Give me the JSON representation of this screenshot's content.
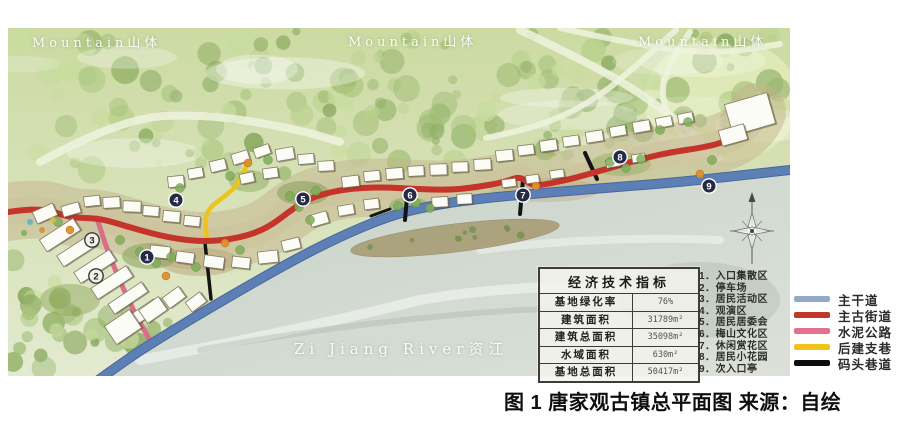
{
  "caption": "图 1 唐家观古镇总平面图  来源：自绘",
  "map_labels": {
    "mountain_left": "Mountain山体",
    "mountain_center": "Mountain山体",
    "mountain_right": "Mountain山体",
    "river": "Zi Jiang River资江"
  },
  "indicators_table": {
    "title": "经济技术指标",
    "rows": [
      {
        "label": "基地绿化率",
        "value": "76%"
      },
      {
        "label": "建筑面积",
        "value": "31789m²"
      },
      {
        "label": "建筑总面积",
        "value": "35098m²"
      },
      {
        "label": "水域面积",
        "value": "630m²"
      },
      {
        "label": "基地总面积",
        "value": "50417m²"
      }
    ]
  },
  "zones": [
    {
      "num": "1．",
      "name": "入口集散区"
    },
    {
      "num": "2．",
      "name": "停车场"
    },
    {
      "num": "3．",
      "name": "居民活动区"
    },
    {
      "num": "4．",
      "name": "观演区"
    },
    {
      "num": "5．",
      "name": "居民居委会"
    },
    {
      "num": "6．",
      "name": "梅山文化区"
    },
    {
      "num": "7．",
      "name": "休闲赏花区"
    },
    {
      "num": "8．",
      "name": "居民小花园"
    },
    {
      "num": "9．",
      "name": "次入口亭"
    }
  ],
  "legend": [
    {
      "label": "主干道",
      "color": "#93a9c9"
    },
    {
      "label": "主古街道",
      "color": "#c0372c"
    },
    {
      "label": "水泥公路",
      "color": "#e4718e"
    },
    {
      "label": "后建支巷",
      "color": "#f2c318"
    },
    {
      "label": "码头巷道",
      "color": "#0d0d0d"
    }
  ],
  "markers": [
    {
      "n": "1",
      "x": 147,
      "y": 257,
      "light": false
    },
    {
      "n": "2",
      "x": 96,
      "y": 276,
      "light": true
    },
    {
      "n": "3",
      "x": 92,
      "y": 240,
      "light": true
    },
    {
      "n": "4",
      "x": 176,
      "y": 200,
      "light": false
    },
    {
      "n": "5",
      "x": 303,
      "y": 199,
      "light": false
    },
    {
      "n": "6",
      "x": 410,
      "y": 195,
      "light": false
    },
    {
      "n": "7",
      "x": 523,
      "y": 195,
      "light": false
    },
    {
      "n": "8",
      "x": 620,
      "y": 157,
      "light": false
    },
    {
      "n": "9",
      "x": 709,
      "y": 186,
      "light": false
    }
  ],
  "map_art": {
    "palette": {
      "base_top": "#ccdaa2",
      "base_bottom": "#e3ead0",
      "river_a": "#c7d2c9",
      "river_b": "#dce1d8",
      "ground": "#c3b48c",
      "ground2": "#cdbf98",
      "grass": "#dfeab8",
      "mountain_path": "#eef3de",
      "building_fill": "#fcfcf6",
      "building_stroke": "#877a63",
      "tree_palette": [
        "#a8c47c",
        "#94b368",
        "#b9d28e",
        "#87a85c",
        "#c8dc9e",
        "#9cb873"
      ],
      "orange_tree": "#e08f2e",
      "town_tree": "#7fae5a",
      "marker_dark": "#252b47",
      "marker_light": "#f2f1ea",
      "sandbar": "#a3956a"
    },
    "roads_bg": [
      {
        "width": 8,
        "points": [
          [
            40,
            162
          ],
          [
            120,
            118
          ],
          [
            210,
            114
          ],
          [
            300,
            130
          ],
          [
            340,
            142
          ]
        ]
      },
      {
        "width": 8,
        "points": [
          [
            520,
            30
          ],
          [
            600,
            68
          ],
          [
            662,
            108
          ],
          [
            700,
            140
          ]
        ]
      },
      {
        "width": 6,
        "points": [
          [
            560,
            28
          ],
          [
            640,
            46
          ],
          [
            718,
            54
          ],
          [
            780,
            44
          ]
        ]
      },
      {
        "width": 6,
        "points": [
          [
            690,
            32
          ],
          [
            664,
            70
          ],
          [
            662,
            108
          ],
          [
            688,
            144
          ],
          [
            720,
            158
          ]
        ]
      },
      {
        "width": 6,
        "points": [
          [
            676,
            30
          ],
          [
            630,
            72
          ],
          [
            588,
            104
          ],
          [
            540,
            126
          ],
          [
            486,
            138
          ]
        ]
      }
    ],
    "river": [
      [
        101,
        376
      ],
      [
        138,
        354
      ],
      [
        178,
        331
      ],
      [
        222,
        304
      ],
      [
        266,
        278
      ],
      [
        310,
        252
      ],
      [
        354,
        230
      ],
      [
        398,
        213
      ],
      [
        443,
        203
      ],
      [
        488,
        197
      ],
      [
        534,
        193
      ],
      [
        584,
        189
      ],
      [
        634,
        185
      ],
      [
        685,
        181
      ],
      [
        738,
        175
      ],
      [
        790,
        169
      ],
      [
        790,
        376
      ]
    ],
    "roads": [
      {
        "name": "cement-road",
        "color": "#d96e88",
        "width": 5,
        "points": [
          [
            97,
            218
          ],
          [
            106,
            247
          ],
          [
            117,
            274
          ],
          [
            128,
            299
          ],
          [
            138,
            319
          ],
          [
            152,
            344
          ]
        ]
      },
      {
        "name": "branch-alley",
        "color": "#edc41e",
        "width": 4.5,
        "points": [
          [
            247,
            164
          ],
          [
            239,
            184
          ],
          [
            224,
            197
          ],
          [
            210,
            207
          ],
          [
            205,
            219
          ],
          [
            207,
            240
          ]
        ]
      },
      {
        "name": "main-road",
        "color": "#5c80b6",
        "width": 8,
        "casing": "#49679c",
        "points": [
          [
            97,
            381
          ],
          [
            130,
            357
          ],
          [
            170,
            332
          ],
          [
            215,
            305
          ],
          [
            260,
            279
          ],
          [
            305,
            254
          ],
          [
            350,
            232
          ],
          [
            395,
            214
          ],
          [
            440,
            204
          ],
          [
            485,
            198
          ],
          [
            530,
            194
          ],
          [
            580,
            190
          ],
          [
            630,
            186
          ],
          [
            680,
            182
          ],
          [
            735,
            176
          ],
          [
            790,
            170
          ]
        ]
      },
      {
        "name": "wharf-lane-1",
        "color": "#141414",
        "width": 3.5,
        "points": [
          [
            205,
            243
          ],
          [
            211,
            299
          ]
        ]
      },
      {
        "name": "wharf-lane-2",
        "color": "#141414",
        "width": 3,
        "points": [
          [
            371,
            216
          ],
          [
            390,
            209
          ]
        ]
      },
      {
        "name": "wharf-lane-3",
        "color": "#141414",
        "width": 4,
        "points": [
          [
            407,
            197
          ],
          [
            405,
            220
          ]
        ]
      },
      {
        "name": "wharf-lane-4",
        "color": "#141414",
        "width": 4,
        "points": [
          [
            523,
            180
          ],
          [
            520,
            214
          ]
        ]
      },
      {
        "name": "wharf-lane-5",
        "color": "#141414",
        "width": 4,
        "points": [
          [
            585,
            153
          ],
          [
            597,
            179
          ]
        ]
      },
      {
        "name": "ancient-street",
        "color": "#c5342b",
        "width": 6,
        "points": [
          [
            8,
            212
          ],
          [
            40,
            207
          ],
          [
            70,
            218
          ],
          [
            100,
            218
          ],
          [
            135,
            229
          ],
          [
            170,
            238
          ],
          [
            205,
            242
          ],
          [
            240,
            238
          ],
          [
            268,
            228
          ],
          [
            295,
            207
          ],
          [
            315,
            196
          ],
          [
            345,
            189
          ],
          [
            380,
            187
          ],
          [
            415,
            189
          ],
          [
            450,
            190
          ],
          [
            478,
            187
          ],
          [
            505,
            182
          ],
          [
            520,
            176
          ],
          [
            532,
            186
          ],
          [
            548,
            184
          ],
          [
            575,
            178
          ],
          [
            610,
            168
          ],
          [
            645,
            158
          ],
          [
            672,
            152
          ],
          [
            700,
            148
          ],
          [
            722,
            143
          ],
          [
            740,
            134
          ],
          [
            752,
            122
          ],
          [
            757,
            112
          ]
        ]
      }
    ],
    "gardens": [
      [
        150,
        256,
        28,
        13,
        "#86a158",
        0.55
      ],
      [
        303,
        193,
        26,
        12,
        "#7e9a52",
        0.5
      ],
      [
        409,
        206,
        20,
        9,
        "#86a158",
        0.45
      ],
      [
        621,
        164,
        30,
        12,
        "#97b168",
        0.5
      ],
      [
        249,
        181,
        20,
        11,
        "#90aa60",
        0.5
      ],
      [
        200,
        262,
        40,
        14,
        "#b2a074",
        0.45
      ],
      [
        545,
        190,
        55,
        12,
        "#bcab82",
        0.4
      ],
      [
        70,
        300,
        30,
        16,
        "#8fa95e",
        0.5
      ]
    ],
    "buildings": [
      [
        40,
        228,
        40,
        14,
        -33
      ],
      [
        57,
        244,
        40,
        13,
        -33
      ],
      [
        74,
        260,
        42,
        13,
        -33
      ],
      [
        91,
        276,
        42,
        13,
        -33
      ],
      [
        108,
        292,
        40,
        12,
        -34
      ],
      [
        124,
        308,
        36,
        12,
        -34
      ],
      [
        34,
        207,
        22,
        13,
        -24
      ],
      [
        62,
        204,
        18,
        11,
        -16
      ],
      [
        84,
        196,
        16,
        10,
        -6
      ],
      [
        103,
        197,
        17,
        11,
        -3
      ],
      [
        123,
        201,
        18,
        11,
        2
      ],
      [
        143,
        206,
        16,
        10,
        4
      ],
      [
        163,
        211,
        17,
        11,
        5
      ],
      [
        184,
        216,
        16,
        10,
        6
      ],
      [
        150,
        246,
        20,
        12,
        6
      ],
      [
        176,
        252,
        18,
        11,
        8
      ],
      [
        204,
        256,
        20,
        12,
        8
      ],
      [
        232,
        257,
        18,
        11,
        6
      ],
      [
        258,
        251,
        20,
        12,
        -6
      ],
      [
        282,
        239,
        18,
        11,
        -14
      ],
      [
        108,
        316,
        30,
        22,
        -34
      ],
      [
        141,
        302,
        24,
        16,
        -35
      ],
      [
        164,
        291,
        20,
        13,
        -36
      ],
      [
        187,
        296,
        18,
        12,
        -37
      ],
      [
        168,
        176,
        16,
        11,
        -6
      ],
      [
        188,
        168,
        15,
        10,
        -10
      ],
      [
        210,
        160,
        16,
        11,
        -14
      ],
      [
        232,
        152,
        17,
        11,
        -17
      ],
      [
        254,
        146,
        16,
        10,
        -19
      ],
      [
        276,
        148,
        18,
        12,
        -10
      ],
      [
        298,
        154,
        16,
        10,
        -5
      ],
      [
        318,
        161,
        16,
        10,
        -3
      ],
      [
        240,
        173,
        14,
        10,
        -12
      ],
      [
        263,
        168,
        15,
        10,
        -8
      ],
      [
        342,
        176,
        17,
        11,
        -7
      ],
      [
        364,
        171,
        16,
        10,
        -5
      ],
      [
        386,
        168,
        17,
        11,
        -4
      ],
      [
        408,
        166,
        16,
        10,
        -3
      ],
      [
        430,
        164,
        17,
        11,
        -2
      ],
      [
        452,
        162,
        16,
        10,
        -2
      ],
      [
        474,
        159,
        17,
        11,
        -3
      ],
      [
        310,
        213,
        18,
        12,
        -16
      ],
      [
        338,
        205,
        16,
        10,
        -10
      ],
      [
        364,
        199,
        15,
        10,
        -7
      ],
      [
        432,
        197,
        16,
        10,
        -3
      ],
      [
        457,
        194,
        15,
        10,
        -3
      ],
      [
        496,
        150,
        17,
        11,
        -6
      ],
      [
        518,
        145,
        16,
        10,
        -7
      ],
      [
        540,
        140,
        17,
        11,
        -8
      ],
      [
        563,
        136,
        16,
        10,
        -8
      ],
      [
        586,
        131,
        17,
        11,
        -9
      ],
      [
        610,
        126,
        16,
        10,
        -10
      ],
      [
        633,
        121,
        17,
        11,
        -10
      ],
      [
        656,
        117,
        16,
        10,
        -11
      ],
      [
        678,
        113,
        15,
        10,
        -11
      ],
      [
        502,
        179,
        14,
        8,
        -7
      ],
      [
        526,
        175,
        13,
        8,
        -8
      ],
      [
        550,
        170,
        14,
        8,
        -8
      ],
      [
        606,
        159,
        14,
        8,
        -10
      ],
      [
        632,
        154,
        13,
        8,
        -10
      ],
      [
        728,
        98,
        44,
        32,
        -16
      ],
      [
        720,
        127,
        26,
        16,
        -16
      ]
    ],
    "town_trees": [
      [
        140,
        252
      ],
      [
        156,
        263
      ],
      [
        171,
        257
      ],
      [
        196,
        267
      ],
      [
        290,
        196
      ],
      [
        299,
        207
      ],
      [
        316,
        191
      ],
      [
        398,
        206
      ],
      [
        416,
        203
      ],
      [
        610,
        162
      ],
      [
        626,
        168
      ],
      [
        641,
        159
      ],
      [
        180,
        188
      ],
      [
        230,
        176
      ],
      [
        268,
        160
      ],
      [
        120,
        240
      ],
      [
        58,
        222
      ],
      [
        660,
        130
      ],
      [
        688,
        122
      ],
      [
        712,
        160
      ],
      [
        240,
        250
      ],
      [
        310,
        220
      ],
      [
        430,
        208
      ]
    ],
    "orange_trees": [
      [
        166,
        276
      ],
      [
        248,
        163
      ],
      [
        536,
        186
      ],
      [
        700,
        174
      ],
      [
        70,
        230
      ],
      [
        225,
        243
      ]
    ],
    "deco_dots": [
      [
        30,
        222,
        "#5ab5c5"
      ],
      [
        42,
        230,
        "#e08f2e"
      ],
      [
        53,
        220,
        "#cfc04a"
      ],
      [
        24,
        233,
        "#7fae5a"
      ]
    ]
  }
}
